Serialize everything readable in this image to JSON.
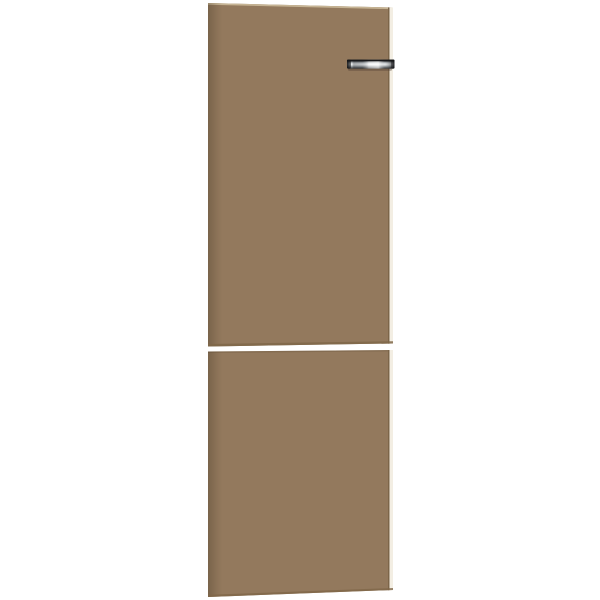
{
  "image": {
    "type": "product-photo",
    "subject": "Refrigerator door panel set: upper fridge door and lower freezer door in coffee brown with a chrome bar handle at the top right, on a plain white background",
    "background": "#ffffff"
  },
  "colors": {
    "background": "#ffffff",
    "panel": "#93795d",
    "panel_left_shade": "#6b563c",
    "panel_edge_line": "#7c6549",
    "panel_edge_light": "#f3eee3",
    "panel_top_highlight": "#c6b494",
    "panel_bottom_shade": "#7f6749",
    "handle_dark": "#17181a",
    "handle_mid": "#c2c7c9",
    "handle_light": "#f6f9fa",
    "handle_end_dark": "#232527",
    "handle_shadow": "rgba(70,55,35,0.45)"
  },
  "parts": {
    "upper_door": "upper refrigerator door panel",
    "lower_door": "lower freezer door panel",
    "door_gap": "horizontal white gap between the two door panels",
    "handle": "chrome bar door handle",
    "handle_shadow": "shadow cast by handle on panel"
  }
}
